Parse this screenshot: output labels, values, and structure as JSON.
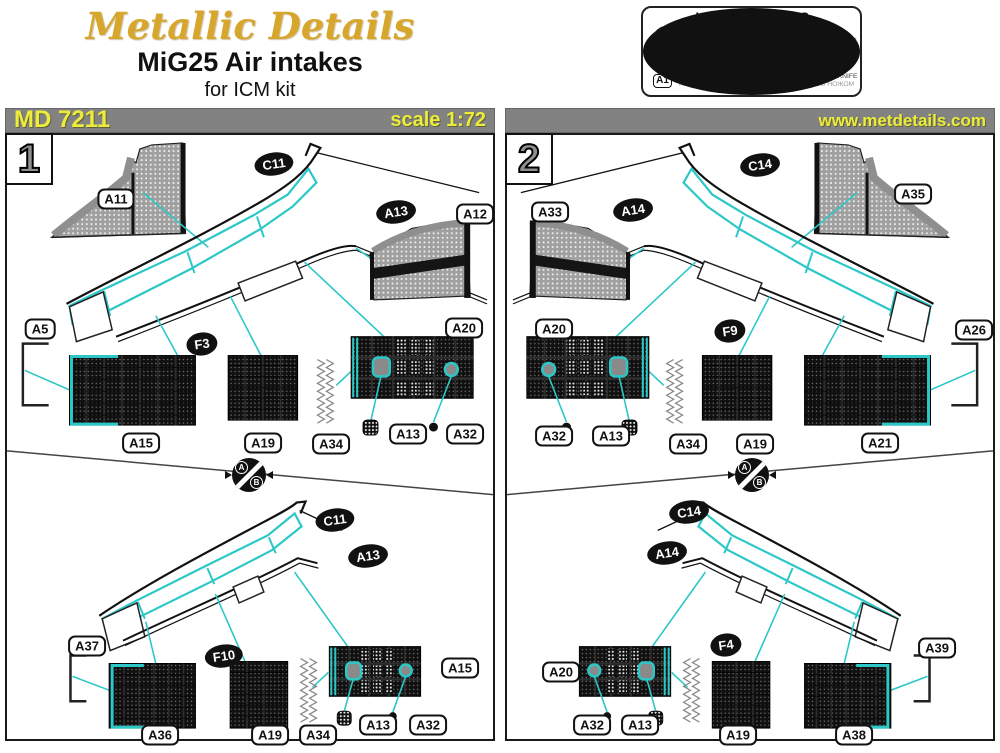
{
  "header": {
    "logo": "Metallic Details",
    "title": "MiG25 Air intakes",
    "subtitle": "for ICM kit"
  },
  "product": {
    "code": "MD 7211",
    "scale": "scale 1:72",
    "website": "www.metdetails.com"
  },
  "symbols_box": {
    "title": "USED SYMBOLS",
    "stage": {
      "glyph": "1",
      "en": "STAGES OF ASSEMBLY",
      "ru": "ЭТАПЫ СБОРКИ"
    },
    "plastic": {
      "glyph": "B1",
      "en": "NUMBER PLASTIC PARTS",
      "ru": "НОМЕР ПЛАСТИКОВОЙ ДЕТАЛИ"
    },
    "parts": {
      "glyph": "A1",
      "en": "NUMBER PARTS",
      "ru": "НОМЕР ДЕТАЛИ"
    },
    "alternatives": {
      "en": "ALTERNATIVES",
      "ru": "ВАРИАНТЫ СБОРКИ"
    },
    "bend": {
      "en": "BEND",
      "ru": "СОГНУТЬ"
    },
    "knife": {
      "en": "DETACH WITH KNIFE",
      "ru": "ОТДЕЛИТЬ НОЖОМ"
    }
  },
  "alt_marker": {
    "a": "A",
    "b": "B"
  },
  "colors": {
    "accent_cyan": "#2cc7c7",
    "bar_gray": "#828282",
    "text_yellow": "#ecec3c",
    "logo_gold": "#d7a62c",
    "knife_red": "#cc2222"
  },
  "panels": [
    {
      "number": "1",
      "labels": [
        {
          "text": "A11",
          "kind": "pe",
          "x": 109,
          "y": 64
        },
        {
          "text": "C11",
          "kind": "pl",
          "x": 267,
          "y": 29
        },
        {
          "text": "A13",
          "kind": "pl",
          "x": 389,
          "y": 77
        },
        {
          "text": "A12",
          "kind": "pe",
          "x": 468,
          "y": 79
        },
        {
          "text": "A5",
          "kind": "pe",
          "x": 33,
          "y": 194
        },
        {
          "text": "F3",
          "kind": "pl",
          "x": 195,
          "y": 209
        },
        {
          "text": "A20",
          "kind": "pe",
          "x": 457,
          "y": 193
        },
        {
          "text": "A15",
          "kind": "pe",
          "x": 134,
          "y": 308
        },
        {
          "text": "A19",
          "kind": "pe",
          "x": 256,
          "y": 308
        },
        {
          "text": "A34",
          "kind": "pe",
          "x": 324,
          "y": 309
        },
        {
          "text": "A13",
          "kind": "pe",
          "x": 401,
          "y": 299
        },
        {
          "text": "A32",
          "kind": "pe",
          "x": 458,
          "y": 299
        },
        {
          "text": "C11",
          "kind": "pl",
          "x": 328,
          "y": 385
        },
        {
          "text": "A13",
          "kind": "pl",
          "x": 361,
          "y": 421
        },
        {
          "text": "A37",
          "kind": "pe",
          "x": 80,
          "y": 511
        },
        {
          "text": "F10",
          "kind": "pl",
          "x": 217,
          "y": 521
        },
        {
          "text": "A36",
          "kind": "pe",
          "x": 153,
          "y": 600
        },
        {
          "text": "A19",
          "kind": "pe",
          "x": 263,
          "y": 600
        },
        {
          "text": "A34",
          "kind": "pe",
          "x": 311,
          "y": 600
        },
        {
          "text": "A15",
          "kind": "pe",
          "x": 453,
          "y": 533
        },
        {
          "text": "A13",
          "kind": "pe",
          "x": 371,
          "y": 590
        },
        {
          "text": "A32",
          "kind": "pe",
          "x": 421,
          "y": 590
        }
      ]
    },
    {
      "number": "2",
      "labels": [
        {
          "text": "A33",
          "kind": "pe",
          "x": 43,
          "y": 77
        },
        {
          "text": "A14",
          "kind": "pl",
          "x": 126,
          "y": 75
        },
        {
          "text": "C14",
          "kind": "pl",
          "x": 253,
          "y": 30
        },
        {
          "text": "A35",
          "kind": "pe",
          "x": 406,
          "y": 59
        },
        {
          "text": "A20",
          "kind": "pe",
          "x": 47,
          "y": 194
        },
        {
          "text": "F9",
          "kind": "pl",
          "x": 223,
          "y": 196
        },
        {
          "text": "A26",
          "kind": "pe",
          "x": 467,
          "y": 195
        },
        {
          "text": "A32",
          "kind": "pe",
          "x": 47,
          "y": 301
        },
        {
          "text": "A13",
          "kind": "pe",
          "x": 104,
          "y": 301
        },
        {
          "text": "A34",
          "kind": "pe",
          "x": 181,
          "y": 309
        },
        {
          "text": "A19",
          "kind": "pe",
          "x": 248,
          "y": 309
        },
        {
          "text": "A21",
          "kind": "pe",
          "x": 373,
          "y": 308
        },
        {
          "text": "C14",
          "kind": "pl",
          "x": 182,
          "y": 377
        },
        {
          "text": "A14",
          "kind": "pl",
          "x": 160,
          "y": 418
        },
        {
          "text": "F4",
          "kind": "pl",
          "x": 219,
          "y": 510
        },
        {
          "text": "A39",
          "kind": "pe",
          "x": 430,
          "y": 513
        },
        {
          "text": "A20",
          "kind": "pe",
          "x": 54,
          "y": 537
        },
        {
          "text": "A32",
          "kind": "pe",
          "x": 85,
          "y": 590
        },
        {
          "text": "A13",
          "kind": "pe",
          "x": 133,
          "y": 590
        },
        {
          "text": "A19",
          "kind": "pe",
          "x": 231,
          "y": 600
        },
        {
          "text": "A38",
          "kind": "pe",
          "x": 347,
          "y": 600
        }
      ]
    }
  ]
}
